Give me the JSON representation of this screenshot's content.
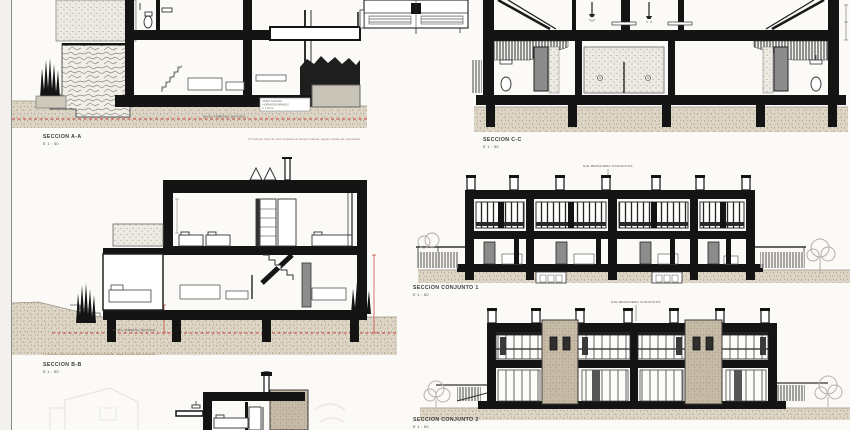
{
  "colors": {
    "paper": "#fbfaf7",
    "ink": "#141414",
    "ground_fill": "#ddd6c7",
    "stone_fill": "#c6bba7",
    "speck_fill": "#edebe4",
    "accent_red": "#c33b33",
    "door_gray": "#8c8c8c"
  },
  "sections": {
    "a": {
      "label": "SECCION A-A",
      "scale": "E 1 : 50",
      "footnote": "(*) Cota de nivel de obra respecto al terreno natural, segun niveles de coronacion",
      "ground_label": "NIVEL TERRENO NATURAL",
      "box_lines": [
        "MURO SOTANO",
        "HORMIGON ARMADO",
        "e = 30 cm"
      ]
    },
    "c": {
      "label": "SECCION C-C",
      "scale": "E 1 : 50"
    },
    "b": {
      "label": "SECCION B-B",
      "scale": "E 1 : 50",
      "footnote": "(*) Cota de nivel de obra respecto al terreno natural, segun niveles de coronacion",
      "ground_label": "NIVEL TERRENO NATURAL"
    },
    "conjunto1": {
      "label": "SECCION CONJUNTO 1",
      "scale": "E 1 : 50",
      "annotation": "EJE MEDIANERA CONJUNTOS"
    },
    "conjunto2": {
      "label": "SECCION CONJUNTO 2",
      "scale": "E 1 : 50",
      "annotation": "EJE MEDIANERA CONJUNTOS"
    }
  }
}
